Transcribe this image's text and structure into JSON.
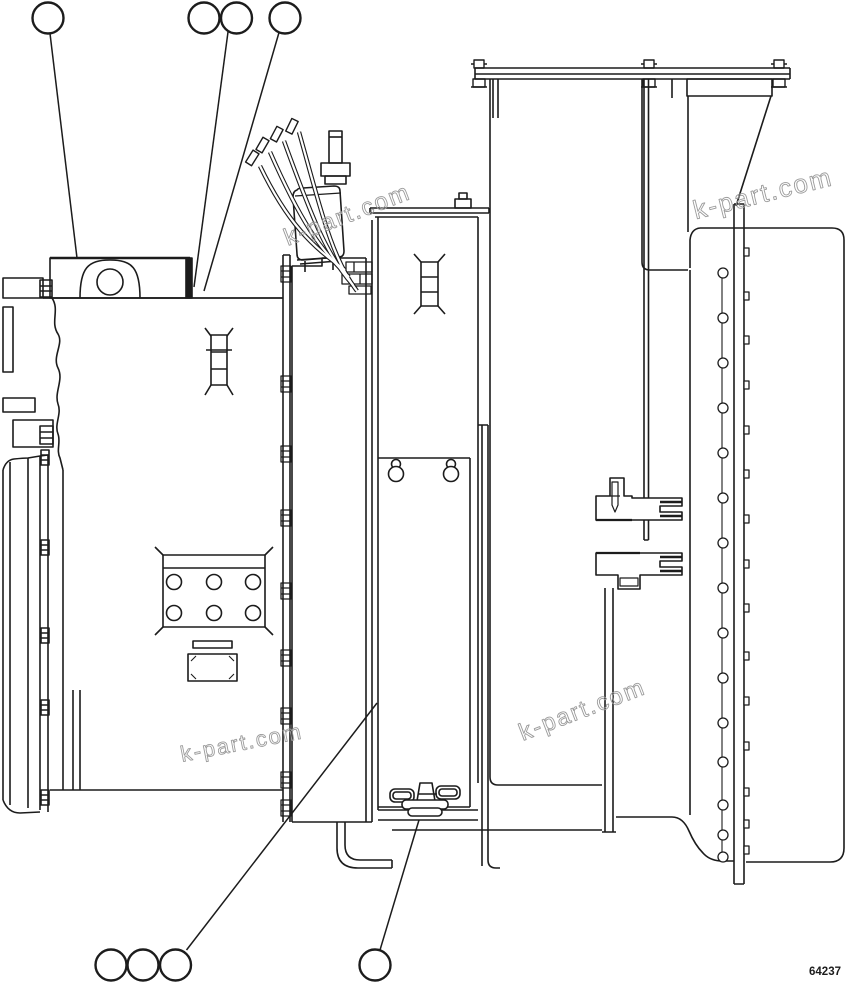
{
  "diagram": {
    "kind": "exploded-parts-line-drawing",
    "background": "#ffffff",
    "line_color": "#1c1c1c"
  },
  "watermark": {
    "text": "k-part.com",
    "color": "#9b9b9b",
    "instances": 4
  },
  "footer": {
    "part_number": "64237"
  },
  "callouts": {
    "top": [
      {
        "label": ""
      },
      {
        "label": ""
      },
      {
        "label": ""
      },
      {
        "label": ""
      }
    ],
    "bottom": [
      {
        "label": ""
      },
      {
        "label": ""
      },
      {
        "label": ""
      },
      {
        "label": ""
      }
    ]
  }
}
